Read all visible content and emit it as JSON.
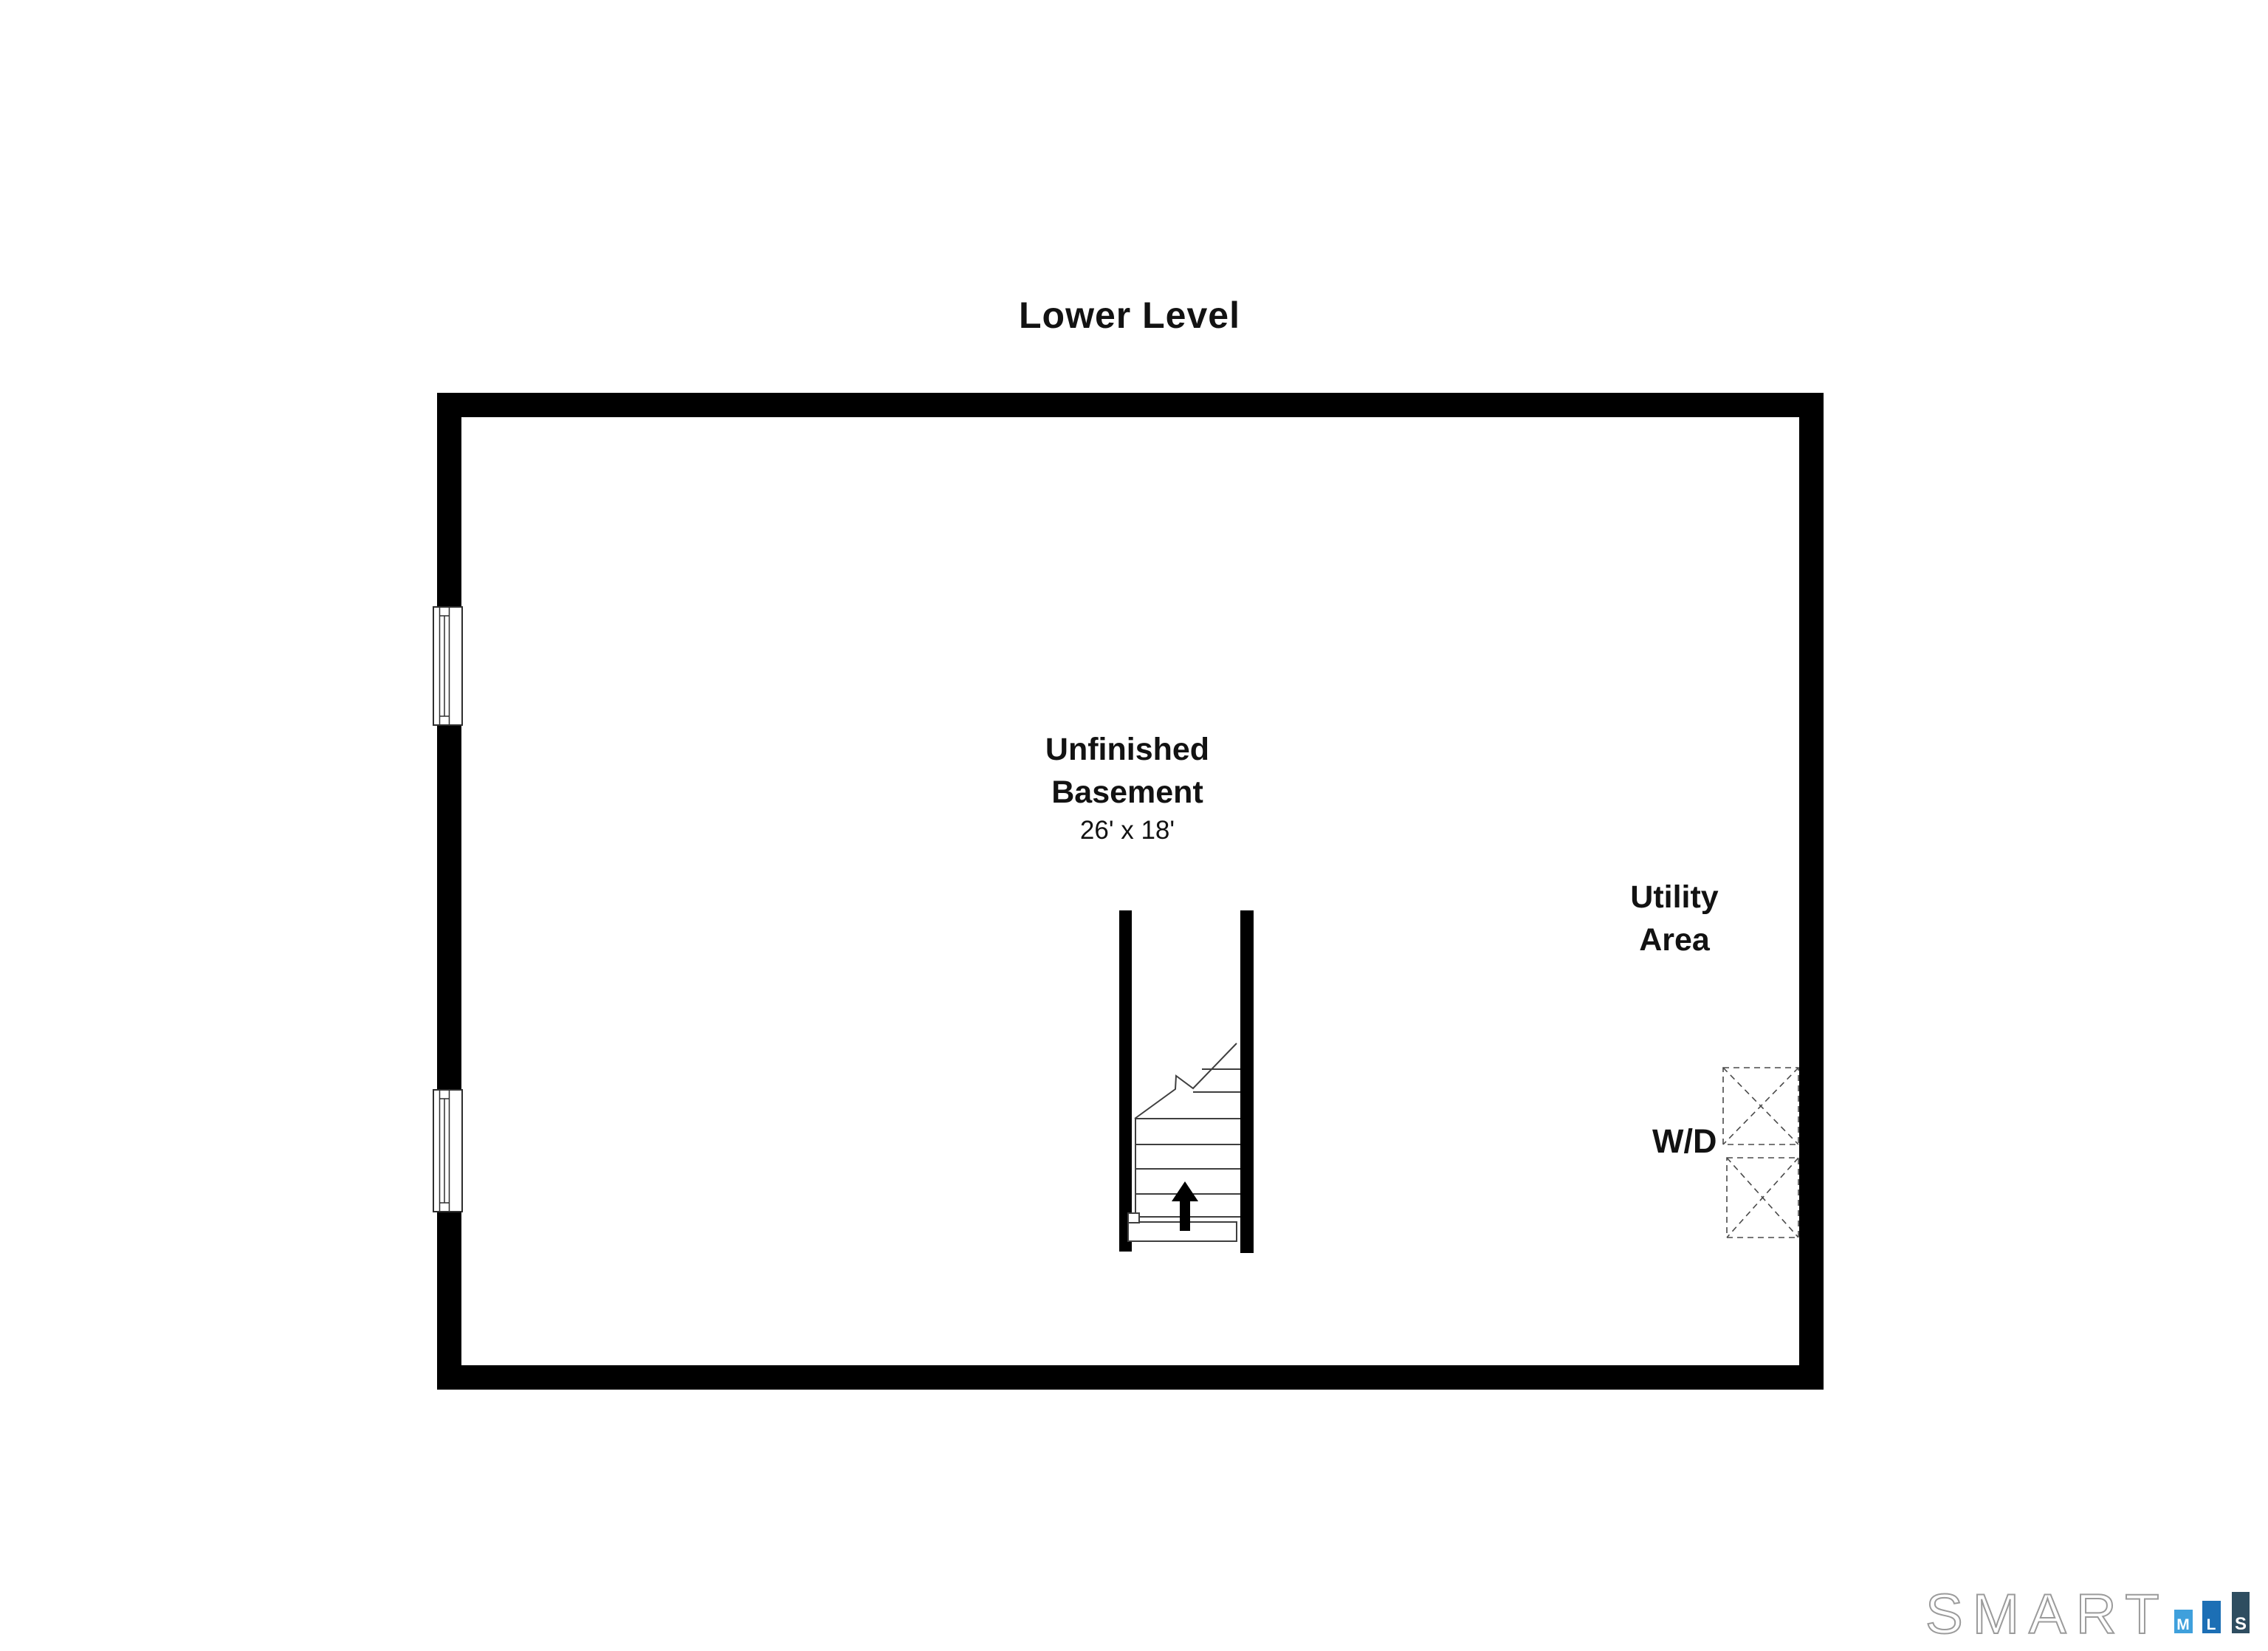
{
  "title": "Lower Level",
  "rooms": {
    "basement": {
      "line1": "Unfinished",
      "line2": "Basement",
      "dims": "26' x 18'"
    },
    "utility": {
      "line1": "Utility",
      "line2": "Area"
    },
    "washer_dryer": "W/D"
  },
  "stairs": {
    "direction": "up"
  },
  "branding": {
    "name": "SMART",
    "mls": [
      "M",
      "L",
      "S"
    ],
    "colors": {
      "m_bar": "#3fa0dc",
      "l_bar": "#1c6fb5",
      "s_bar": "#2e4d60",
      "outline": "#9b9b9b"
    }
  }
}
